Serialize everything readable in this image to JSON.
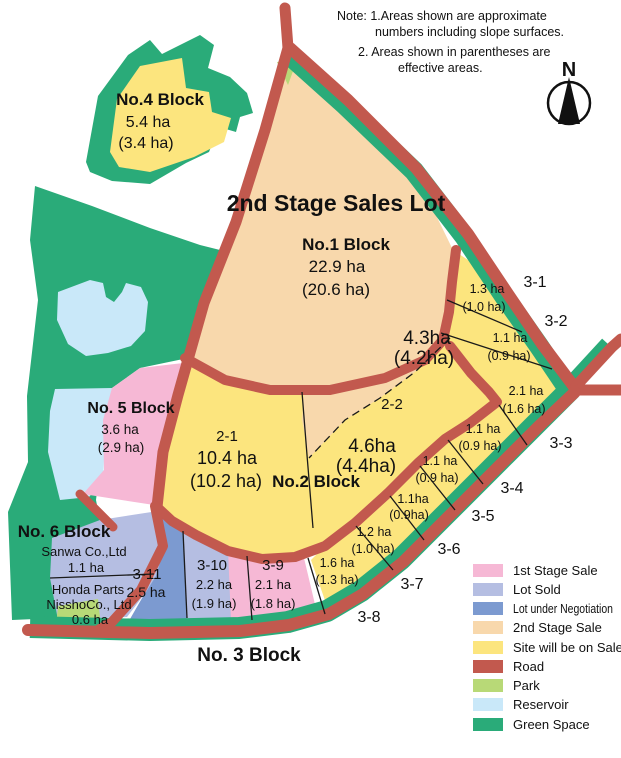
{
  "note": {
    "line1": "Note: 1.Areas shown are approximate",
    "line2": "numbers including slope surfaces.",
    "line3": "2. Areas shown in parentheses are",
    "line4": "effective areas."
  },
  "compass": {
    "label": "N"
  },
  "stage_title": "2nd Stage Sales Lot",
  "blocks": {
    "no1": {
      "name": "No.1 Block",
      "area": "22.9 ha",
      "effective": "(20.6 ha)"
    },
    "no2": {
      "name": "No.2 Block"
    },
    "no3": {
      "name": "No. 3 Block"
    },
    "no4": {
      "name": "No.4 Block",
      "area": "5.4 ha",
      "effective": "(3.4 ha)"
    },
    "no5": {
      "name": "No. 5 Block",
      "area": "3.6 ha",
      "effective": "(2.9 ha)"
    },
    "no6": {
      "name": "No. 6 Block"
    }
  },
  "lots": {
    "l21": {
      "id": "2-1",
      "area": "10.4 ha",
      "effective": "(10.2 ha)"
    },
    "l22": {
      "id": "2-2",
      "area_north": "4.3ha",
      "effective_north": "(4.2ha)",
      "area_south": "4.6ha",
      "effective_south": "(4.4ha)"
    },
    "l31": {
      "id": "3-1",
      "area": "1.3 ha",
      "effective": "(1.0 ha)"
    },
    "l32": {
      "id": "3-2",
      "area": "1.1 ha",
      "effective": "(0.9 ha)"
    },
    "l33": {
      "id": "3-3",
      "area": "2.1 ha",
      "effective": "(1.6 ha)"
    },
    "l34": {
      "id": "3-4",
      "area": "1.1 ha",
      "effective": "(0.9 ha)"
    },
    "l35": {
      "id": "3-5",
      "area": "1.1 ha",
      "effective": "(0.9 ha)"
    },
    "l36": {
      "id": "3-6",
      "area": "1.1ha",
      "effective": "(0.9ha)"
    },
    "l37": {
      "id": "3-7",
      "area": "1.2 ha",
      "effective": "(1.0 ha)"
    },
    "l38": {
      "id": "3-8",
      "area": "1.6 ha",
      "effective": "(1.3 ha)"
    },
    "l39": {
      "id": "3-9",
      "area": "2.1 ha",
      "effective": "(1.8 ha)"
    },
    "l310": {
      "id": "3-10",
      "area": "2.2 ha",
      "effective": "(1.9 ha)"
    },
    "l311": {
      "id": "3-11",
      "area": "2.5 ha"
    },
    "sanwa": {
      "company": "Sanwa Co.,Ltd",
      "area": "1.1 ha"
    },
    "honda": {
      "company_line1": "Honda Parts",
      "company_line2": "NisshoCo., Ltd",
      "area": "0.6 ha"
    }
  },
  "legend": {
    "items": [
      {
        "label": "1st Stage Sale",
        "color": "#F6B8D5"
      },
      {
        "label": "Lot Sold",
        "color": "#B5BEE2"
      },
      {
        "label": "Lot under Negotiation",
        "color": "#7C9AD0"
      },
      {
        "label": "2nd Stage Sale",
        "color": "#F8D8AC"
      },
      {
        "label": "Site will be on Sale",
        "color": "#FCE57E"
      },
      {
        "label": "Road",
        "color": "#C2594E"
      },
      {
        "label": "Park",
        "color": "#B8D977"
      },
      {
        "label": "Reservoir",
        "color": "#C9E8F9"
      },
      {
        "label": "Green Space",
        "color": "#2AAB79"
      }
    ]
  },
  "colors": {
    "pink": "#F6B8D5",
    "lot_sold": "#B5BEE2",
    "negotiation": "#7C9AD0",
    "stage2": "#F8D8AC",
    "on_sale": "#FCE57E",
    "road": "#C2594E",
    "park": "#B8D977",
    "reservoir": "#C9E8F9",
    "green": "#2AAB79",
    "title_red": "#E8121C"
  }
}
